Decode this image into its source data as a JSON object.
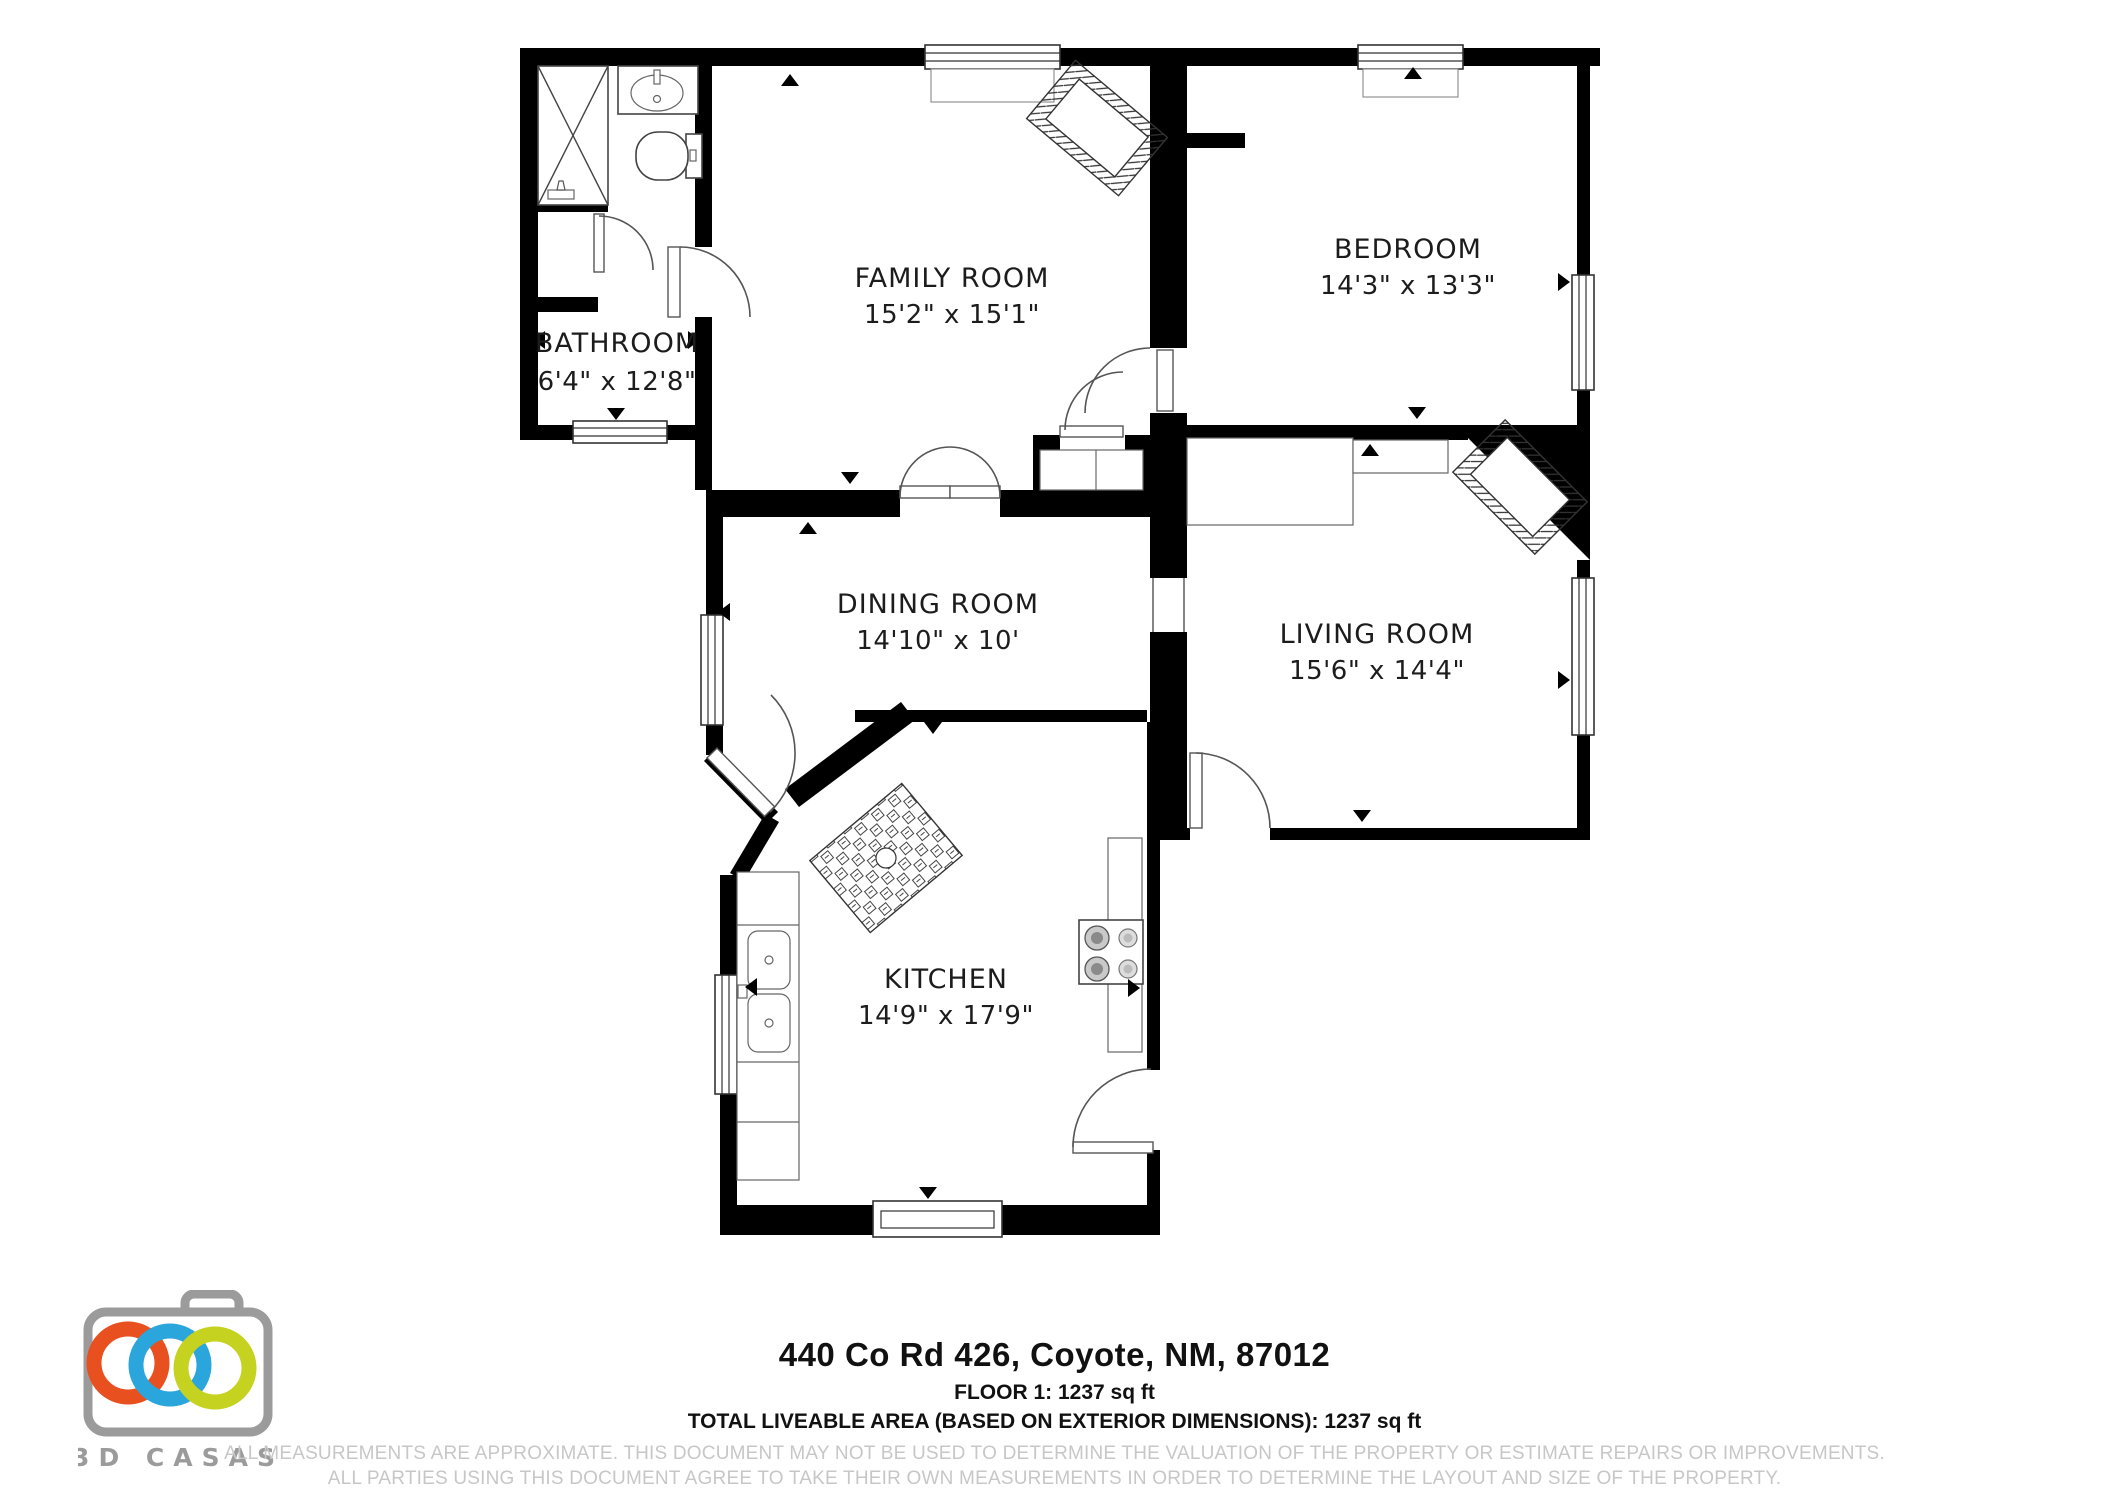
{
  "floorplan": {
    "rooms": [
      {
        "name": "FAMILY ROOM",
        "dims": "15'2\" x 15'1\""
      },
      {
        "name": "BEDROOM",
        "dims": "14'3\" x 13'3\""
      },
      {
        "name": "BATHROOM",
        "dims": "6'4\" x 12'8\""
      },
      {
        "name": "DINING ROOM",
        "dims": "14'10\" x 10'"
      },
      {
        "name": "LIVING ROOM",
        "dims": "15'6\" x 14'4\""
      },
      {
        "name": "KITCHEN",
        "dims": "14'9\" x 17'9\""
      }
    ],
    "fixture_icons": [
      "shower-icon",
      "bathroom-sink-icon",
      "toilet-icon",
      "fireplace-icon",
      "sofa-icon",
      "rug-icon",
      "kitchen-sink-icon",
      "stove-icon",
      "window-icon",
      "door-icon"
    ]
  },
  "footer": {
    "address": "440 Co Rd 426, Coyote, NM, 87012",
    "floor_area": "FLOOR 1: 1237 sq ft",
    "total_area": "TOTAL LIVEABLE AREA (BASED ON EXTERIOR DIMENSIONS): 1237 sq ft",
    "disclaimer_line1": "ALL MEASUREMENTS ARE APPROXIMATE. THIS DOCUMENT MAY NOT BE USED TO DETERMINE THE VALUATION OF THE PROPERTY OR ESTIMATE REPAIRS OR IMPROVEMENTS.",
    "disclaimer_line2": "ALL PARTIES USING THIS DOCUMENT AGREE TO TAKE THEIR OWN MEASUREMENTS IN ORDER TO DETERMINE THE LAYOUT AND SIZE OF THE PROPERTY."
  },
  "logo": {
    "text": "3D CASAS",
    "colors": {
      "camera_gray": "#9b9b9b",
      "ring_orange": "#e8511f",
      "ring_blue": "#2aa6dc",
      "ring_green": "#c5d21f"
    }
  }
}
